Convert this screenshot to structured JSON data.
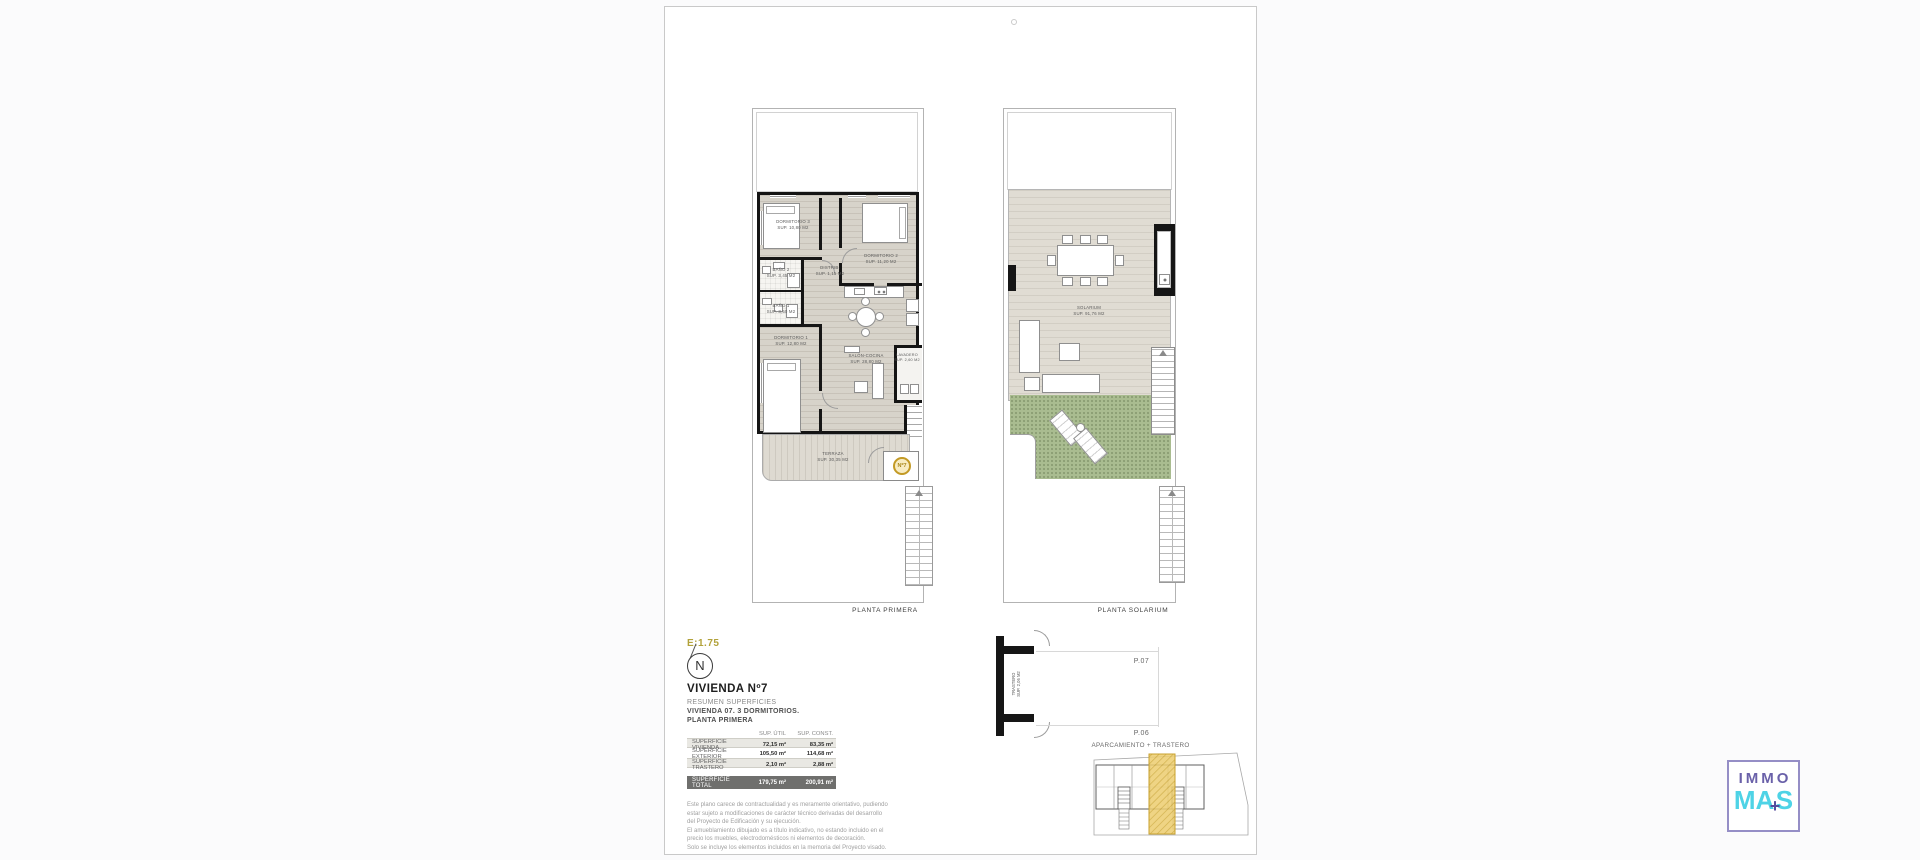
{
  "page": {
    "plans": {
      "primera": {
        "title": "PLANTA PRIMERA",
        "rooms": {
          "dorm3": {
            "name": "DORMITORIO 3",
            "sup": "SUP. 10,80 M2"
          },
          "dorm2": {
            "name": "DORMITORIO 2",
            "sup": "SUP. 11,20 M2"
          },
          "bano2": {
            "name": "BAÑO 2",
            "sup": "SUP. 3,45 M2"
          },
          "distrib": {
            "name": "DISTRIB.",
            "sup": "SUP. 1,15 M2"
          },
          "bano1": {
            "name": "BAÑO 1",
            "sup": "SUP. 3,50 M2"
          },
          "dorm1": {
            "name": "DORMITORIO 1",
            "sup": "SUP. 12,80 M2"
          },
          "salon": {
            "name": "SALÓN-COCINA",
            "sup": "SUP. 28,80 M2"
          },
          "lavadero": {
            "name": "LAVADERO",
            "sup": "SUP. 2,60 M2"
          },
          "terraza": {
            "name": "TERRAZA",
            "sup": "SUP. 30,35 M2"
          }
        },
        "unit_badge": "Nº7"
      },
      "solarium": {
        "title": "PLANTA SOLARIUM",
        "rooms": {
          "solarium": {
            "name": "SOLARIUM",
            "sup": "SUP. 91,76 M2"
          }
        }
      }
    },
    "scale_label": "E:1.75",
    "compass_letter": "N",
    "summary": {
      "title": "VIVIENDA Nº7",
      "subtitle": "RESUMEN SUPERFICIES",
      "line_unit": "VIVIENDA 07. 3 DORMITORIOS.",
      "line_floor": "PLANTA PRIMERA",
      "table": {
        "col_util": "SUP. ÚTIL",
        "col_const": "SUP. CONST.",
        "rows": [
          {
            "label": "SUPERFICIE VIVIENDA",
            "util": "72,15 m²",
            "constr": "83,35 m²"
          },
          {
            "label": "SUPERFICIE EXTERIOR",
            "util": "105,50 m²",
            "constr": "114,68 m²"
          },
          {
            "label": "SUPERFICIE TRASTERO",
            "util": "2,10 m²",
            "constr": "2,88 m²"
          }
        ],
        "total": {
          "label": "SUPERFICIE TOTAL",
          "util": "179,75 m²",
          "constr": "200,91 m²"
        }
      },
      "disclaimer": [
        "Este plano carece de contractualidad y es meramente orientativo, pudiendo",
        "estar sujeto a modificaciones de carácter técnico derivadas del desarrollo",
        "del Proyecto de Edificación y su ejecución.",
        "El amueblamiento dibujado es a título indicativo, no estando incluido en el",
        "precio los muebles, electrodomésticos ni elementos de decoración.",
        "Solo se incluye los elementos incluidos en la memoria del Proyecto visado."
      ]
    },
    "storage_detail": {
      "room": "TRASTERO",
      "sup": "SUP. 2,06 M2",
      "space_top": "P.07",
      "space_bottom": "P.06",
      "title": "APARCAMIENTO + TRASTERO"
    }
  },
  "logo": {
    "line1": "IMMO",
    "mas_left": "MA",
    "plus": "+",
    "mas_right": "S"
  },
  "colors": {
    "highlight_yellow": "#eccd6f",
    "badge_gold": "#c9a22c",
    "logo_purple": "#6a61a9",
    "logo_cyan": "#4ed3e6",
    "plan_green": "#a9bc90",
    "scale_olive": "#b2a23a"
  }
}
